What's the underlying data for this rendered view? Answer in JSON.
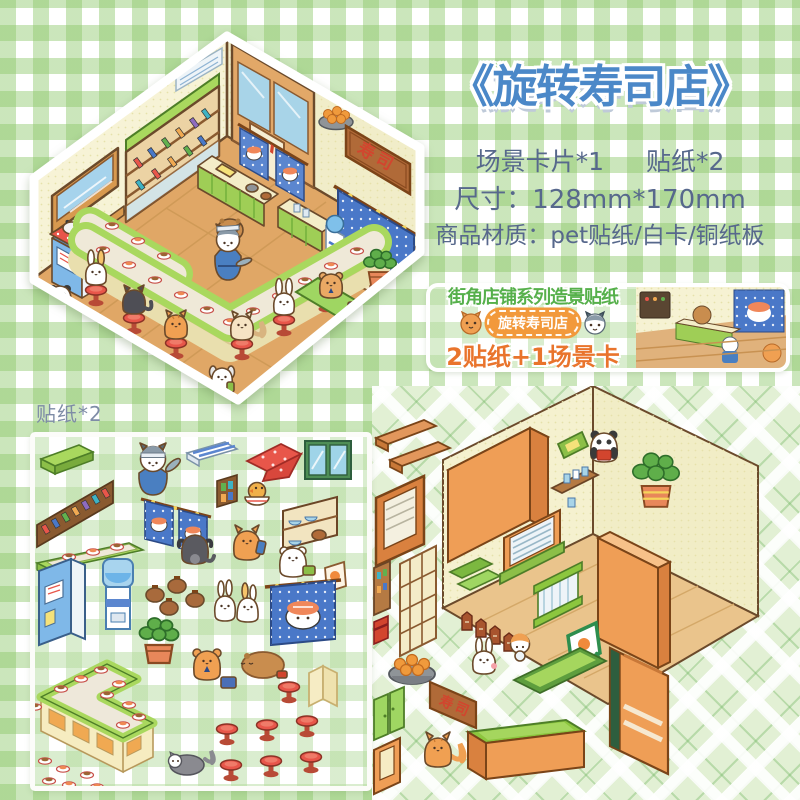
{
  "product": {
    "title": "《旋转寿司店》",
    "contents_card": "场景卡片*1",
    "contents_stickers": "贴纸*2",
    "size_line": "尺寸：128mm*170mm",
    "material_line": "商品材质：pet贴纸/白卡/铜纸板"
  },
  "banner": {
    "series_title": "街角店铺系列造景贴纸",
    "shop_badge": "旋转寿司店",
    "bundle_line": "2贴纸+1场景卡"
  },
  "labels": {
    "sticker_sheet": "贴纸*2"
  },
  "illustration": {
    "sushi_sign": "寿司",
    "scene": "isometric-sushi-restaurant-with-animal-characters"
  },
  "colors": {
    "title_blue": "#4b88c8",
    "spec_text": "#57688c",
    "series_green": "#56b04b",
    "badge_orange": "#f2993b",
    "bundle_orange": "#e9742c",
    "gingham_green": "#cbe6bb",
    "wall_cream": "#f6f2d3",
    "floor_wood": "#e0a766",
    "counter_green": "#a9d85e",
    "stool_red": "#e8564a",
    "noren_blue": "#4a78c8",
    "box_orange": "#ef9e56",
    "label_gray": "#7e8ca6"
  }
}
